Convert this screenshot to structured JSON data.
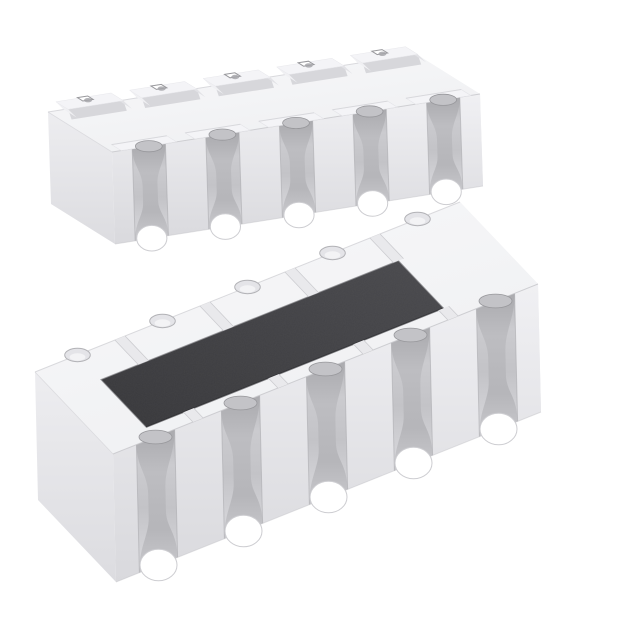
{
  "image": {
    "type": "product-photo",
    "subject": "Two white ceramic SMD convex resistor array packages shown in isometric view; upper unit flipped to show bottom terminal pads, lower unit upright showing dark resistive element coating",
    "background": "#ffffff",
    "components": [
      {
        "id": "array-bottom-view",
        "description": "resistor array, upside down, castellated terminals and bottom pads visible",
        "terminals_per_long_side": 5,
        "castellations_total": 10
      },
      {
        "id": "array-top-view",
        "description": "resistor array, top side up, dark protective resistive coating visible",
        "terminals_per_long_side": 5,
        "castellations_total": 10,
        "coating_color": "#424245"
      }
    ],
    "palette": {
      "background": "#ffffff",
      "top_face_light": "#f8f8fa",
      "top_face_dark": "#eff0f2",
      "near_face_light": "#f0f0f3",
      "near_face_dark": "#d9d9dd",
      "left_face_light": "#ededf0",
      "left_face_dark": "#dcdce0",
      "right_face_light": "#f3f3f5",
      "right_face_dark": "#e6e6ea",
      "groove_top": "#b6b6ba",
      "groove_mid": "#cbcbcf",
      "groove_low": "#d9d9dd",
      "waist_dark": "#a9a9ad",
      "waist_mid": "#bcbcc0",
      "waist_low": "#c8c8cc",
      "pad_top": "#f4f4f7",
      "pad_bevel": "#d7d7db",
      "pad_bevel_side": "#e2e2e6",
      "pad_bevel_light": "#f0f0f3",
      "edge_line": "#c6c6ca",
      "crease": "#d6d6da",
      "seam": "#a8a8ac",
      "bite_fill": "#c3c3c7",
      "bite_rim": "#97979b",
      "far_bite_fill": "#e4e4e8",
      "far_bite_rim": "#b2b2b6",
      "notch_rim": "#98989c",
      "sep_fill": "#e9e9ec",
      "sep_line": "#c9c9cd",
      "arch_rim": "#cdcdd1",
      "coating_light": "#4a4a4e",
      "coating_dark": "#38383b",
      "coating_highlight": "#8e8e92",
      "coating_edge_shadow": "#232326",
      "white": "#ffffff"
    }
  }
}
